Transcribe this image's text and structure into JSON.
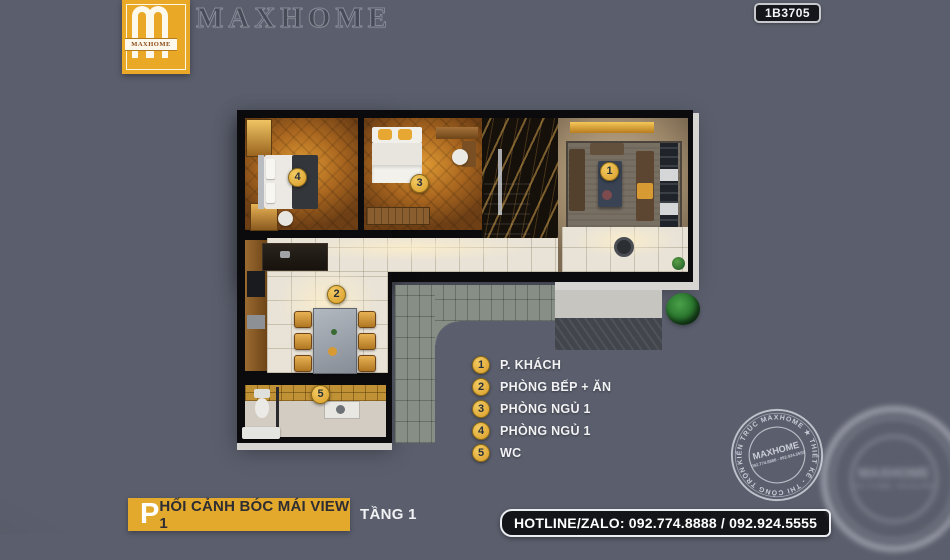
{
  "header": {
    "logo": {
      "brand": "MAXHOME"
    },
    "title": "MAXHOME",
    "code": "1B3705"
  },
  "legend": {
    "items": [
      {
        "number": "1",
        "label": "P. KHÁCH"
      },
      {
        "number": "2",
        "label": "PHÒNG BẾP + ĂN"
      },
      {
        "number": "3",
        "label": "PHÒNG NGỦ 1"
      },
      {
        "number": "4",
        "label": "PHÒNG NGỦ 1"
      },
      {
        "number": "5",
        "label": "WC"
      }
    ]
  },
  "footer": {
    "view_title_initial": "P",
    "view_title_rest": "HỐI CẢNH BÓC MÁI VIEW 1",
    "floor_label": "TẦNG 1",
    "hotline": "HOTLINE/ZALO: 092.774.8888 / 092.924.5555"
  },
  "watermark": {
    "ring_text": "KIẾN TRÚC MAXHOME ★ THIẾT KẾ - THI CÔNG TRỌN GÓI ★",
    "brand": "MAXHOME",
    "phone": "092.774.8888 - 092.924.5555"
  },
  "colors": {
    "background": "#5b5f6d",
    "accent_gold": "#e3a92c",
    "wall_black": "#0b0b0d",
    "badge_gold": "#d99c28",
    "terrace_gray": "#878e85",
    "legend_text": "#f2f2f4"
  }
}
